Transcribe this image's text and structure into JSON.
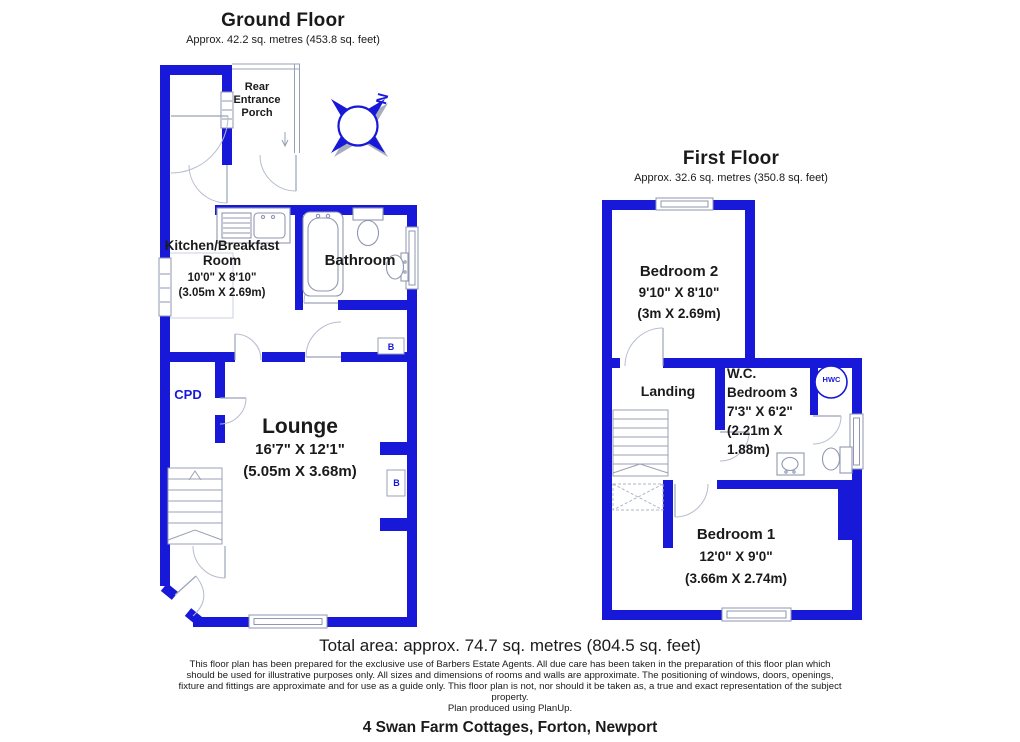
{
  "colors": {
    "wall_blue": "#1718d8",
    "label_blue": "#1718d8",
    "text_black": "#1a1a1a"
  },
  "ground_floor": {
    "title": "Ground Floor",
    "area": "Approx. 42.2 sq. metres (453.8 sq. feet)",
    "porch": {
      "line1": "Rear",
      "line2": "Entrance",
      "line3": "Porch"
    },
    "kitchen": {
      "name_line1": "Kitchen/Breakfast",
      "name_line2": "Room",
      "dims": "10'0\" X 8'10\"",
      "metric": "(3.05m X 2.69m)"
    },
    "bathroom": {
      "name": "Bathroom"
    },
    "lounge": {
      "name": "Lounge",
      "dims": "16'7\" X 12'1\"",
      "metric": "(5.05m X 3.68m)"
    },
    "cupboard_label": "CPD",
    "boiler_label": "B"
  },
  "first_floor": {
    "title": "First Floor",
    "area": "Approx. 32.6 sq. metres (350.8 sq. feet)",
    "bedroom2": {
      "name": "Bedroom 2",
      "dims": "9'10\" X 8'10\"",
      "metric": "(3m X 2.69m)"
    },
    "landing": {
      "name": "Landing"
    },
    "wc_bedroom3": {
      "line1": "W.C.",
      "line2": "Bedroom 3",
      "line3": "7'3\" X 6'2\"",
      "line4": "(2.21m X",
      "line5": "1.88m)"
    },
    "bedroom1": {
      "name": "Bedroom 1",
      "dims": "12'0\" X 9'0\"",
      "metric": "(3.66m X 2.74m)"
    },
    "hwc_label": "HWC"
  },
  "compass": {
    "north_label": "N"
  },
  "footer": {
    "total_area": "Total area: approx. 74.7 sq. metres (804.5 sq. feet)",
    "disclaimer_lines": [
      "This floor plan has been prepared for the exclusive use of Barbers Estate Agents. All due care has been taken in the preparation of this floor plan which",
      "should be used for illustrative purposes only. All sizes and dimensions of rooms and walls are approximate. The positioning of windows, doors, openings,",
      "fixture and fittings are approximate and for use as a guide only. This floor plan is not, nor should it be taken as, a true and exact representation of the subject",
      "property.",
      "Plan produced using PlanUp."
    ],
    "address": "4 Swan Farm Cottages, Forton, Newport"
  }
}
